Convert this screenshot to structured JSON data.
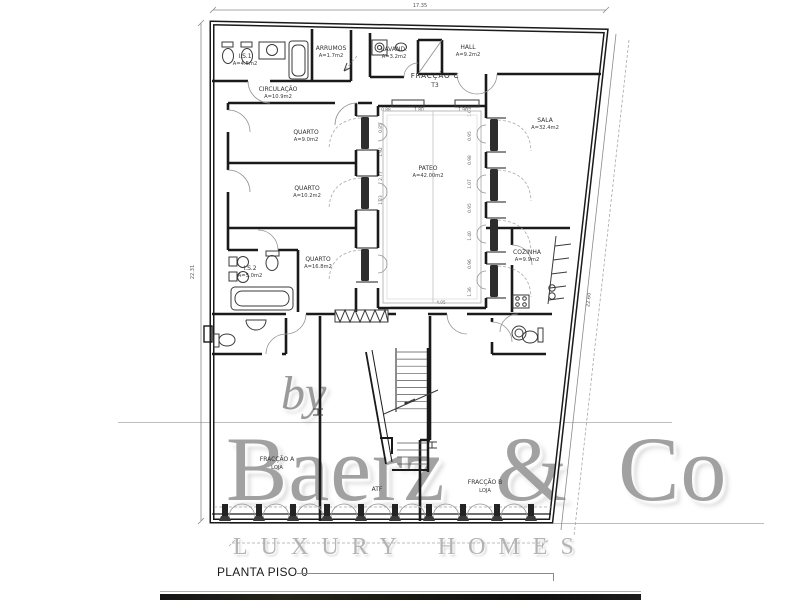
{
  "title_block": {
    "label": "PLANTA PISO 0"
  },
  "watermark": {
    "by": "by",
    "brand": "Baerz & Co",
    "tagline": "LUXURY HOMES"
  },
  "plan": {
    "fraction_c": {
      "name": "FRACÇÃO C",
      "type": "T3"
    },
    "rooms": [
      {
        "name": "I.S.1",
        "area": "A=4.5m2"
      },
      {
        "name": "ARRUMOS",
        "area": "A=1.7m2"
      },
      {
        "name": "LAVAND.",
        "area": "A=3.2m2"
      },
      {
        "name": "HALL",
        "area": "A=9.2m2"
      },
      {
        "name": "CIRCULAÇÃO",
        "area": "A=10.9m2"
      },
      {
        "name": "QUARTO",
        "area": "A=9.0m2"
      },
      {
        "name": "QUARTO",
        "area": "A=10.2m2"
      },
      {
        "name": "I.S.2",
        "area": "A=5.0m2"
      },
      {
        "name": "QUARTO",
        "area": "A=16.8m2"
      },
      {
        "name": "PATEO",
        "area": "A=42.00m2"
      },
      {
        "name": "SALA",
        "area": "A=32.4m2"
      },
      {
        "name": "COZINHA",
        "area": "A=9.9m2"
      },
      {
        "name": "FRACÇÃO A",
        "area": "LOJA"
      },
      {
        "name": "ATF",
        "area": ""
      },
      {
        "name": "FRACÇÃO B",
        "area": "LOJA"
      }
    ],
    "dimensions": {
      "top_width": "17.35",
      "left_height": "22.31",
      "right_length": "22.60",
      "patio_width": "4.95",
      "patio_top": [
        "0.88",
        "1.80",
        "1.96"
      ],
      "patio_left": [
        "0.85",
        "1.92",
        "2.77",
        "1.23"
      ],
      "patio_right": [
        "1.03",
        "0.95",
        "0.98",
        "1.07",
        "0.95",
        "1.40",
        "0.96",
        "1.36"
      ]
    }
  }
}
